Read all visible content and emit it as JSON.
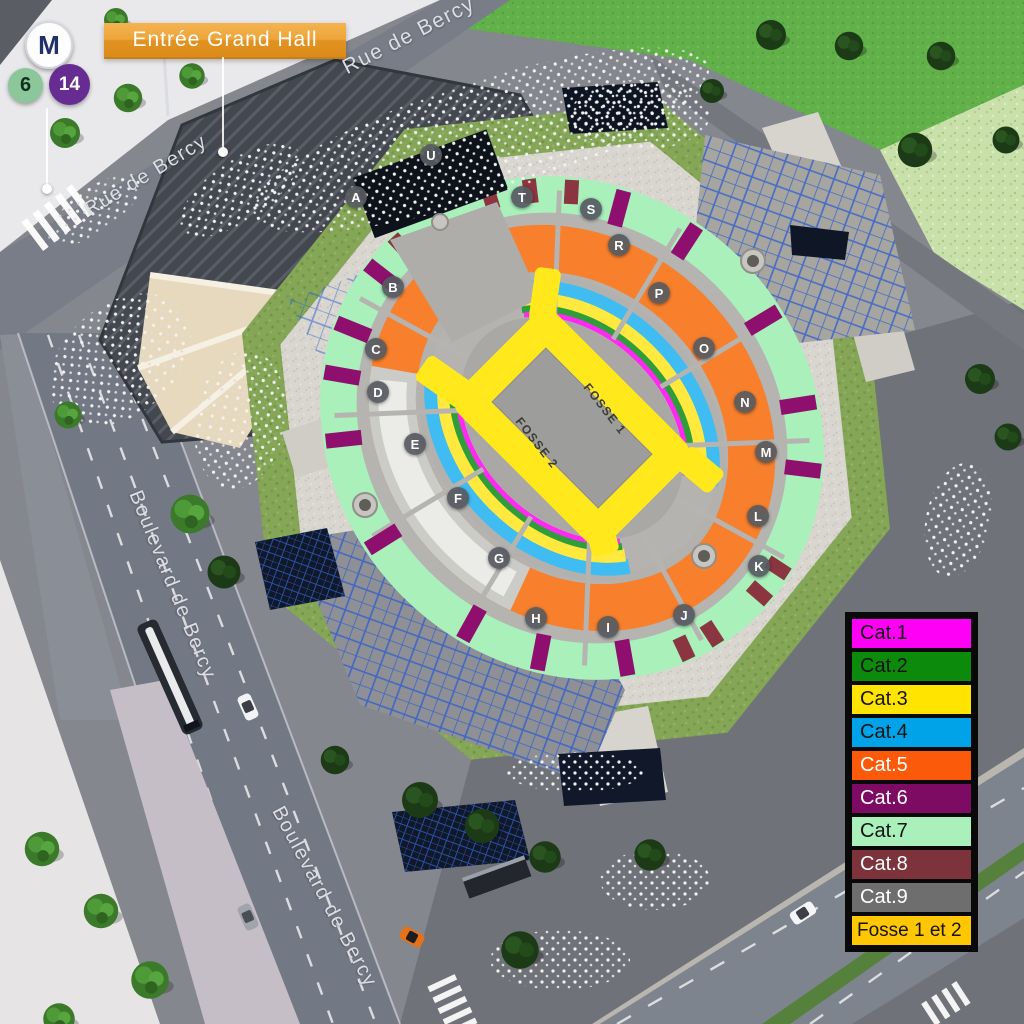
{
  "entrance": {
    "label": "Entrée Grand Hall"
  },
  "transit": {
    "metro_badge": "M",
    "lines": [
      {
        "number": "6",
        "color": "#8bc79a"
      },
      {
        "number": "14",
        "color": "#662c91"
      }
    ]
  },
  "streets": {
    "rue_top": "Rue de Bercy",
    "rue_left": "Rue de Bercy",
    "blvd_upper": "Boulevard de Bercy",
    "blvd_lower": "Boulevard de Bercy"
  },
  "arena": {
    "fosse_zones": [
      {
        "label": "FOSSE 1"
      },
      {
        "label": "FOSSE 2"
      }
    ],
    "sections": [
      {
        "letter": "A"
      },
      {
        "letter": "B"
      },
      {
        "letter": "C"
      },
      {
        "letter": "D"
      },
      {
        "letter": "E"
      },
      {
        "letter": "F"
      },
      {
        "letter": "G"
      },
      {
        "letter": "H"
      },
      {
        "letter": "I"
      },
      {
        "letter": "J"
      },
      {
        "letter": "K"
      },
      {
        "letter": "L"
      },
      {
        "letter": "M"
      },
      {
        "letter": "N"
      },
      {
        "letter": "O"
      },
      {
        "letter": "P"
      },
      {
        "letter": "R"
      },
      {
        "letter": "S"
      },
      {
        "letter": "T"
      },
      {
        "letter": "U"
      }
    ]
  },
  "legend": {
    "items": [
      {
        "label": "Cat.1",
        "color": "#ff00f6",
        "text_color": "#141414"
      },
      {
        "label": "Cat.2",
        "color": "#0b8a0b",
        "text_color": "#141414"
      },
      {
        "label": "Cat.3",
        "color": "#ffe400",
        "text_color": "#141414"
      },
      {
        "label": "Cat.4",
        "color": "#00a3e8",
        "text_color": "#141414"
      },
      {
        "label": "Cat.5",
        "color": "#fa5a0a",
        "text_color": "#ffffff"
      },
      {
        "label": "Cat.6",
        "color": "#7d0a63",
        "text_color": "#ffffff"
      },
      {
        "label": "Cat.7",
        "color": "#aaf0bb",
        "text_color": "#141414"
      },
      {
        "label": "Cat.8",
        "color": "#7d333b",
        "text_color": "#ffffff"
      },
      {
        "label": "Cat.9",
        "color": "#6e6e6e",
        "text_color": "#ffffff"
      },
      {
        "label": "Fosse 1 et 2",
        "color": "#fec701",
        "text_color": "#141414"
      }
    ]
  }
}
